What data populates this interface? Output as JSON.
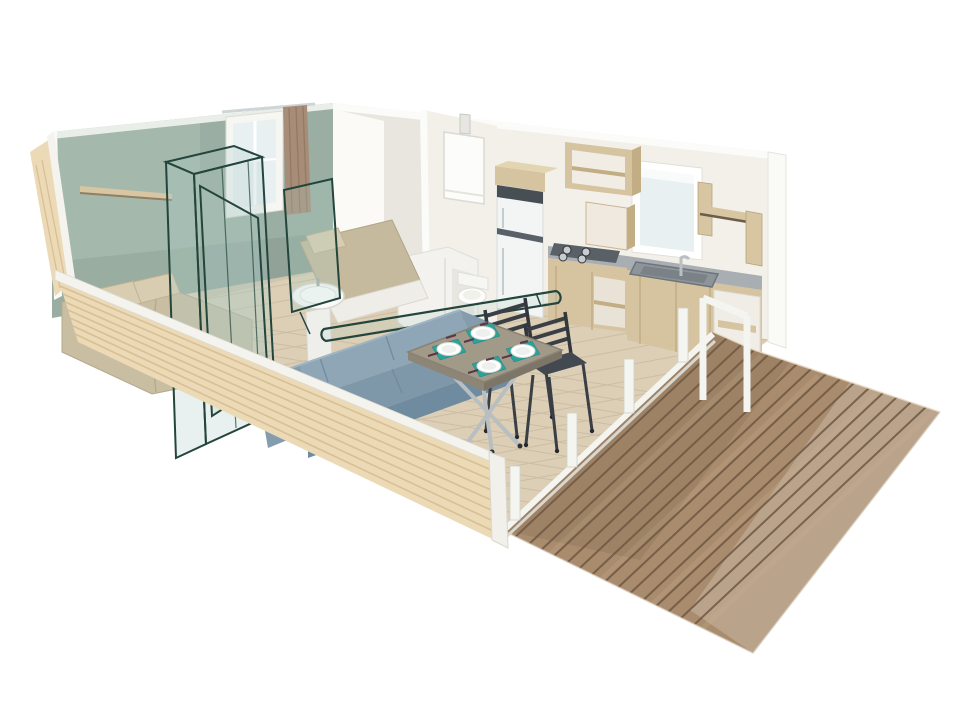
{
  "image": {
    "kind": "isometric-cutaway-render",
    "subject": "mobile-home-floorplan-3d"
  },
  "palette": {
    "background": "#ffffff",
    "wall_green": "#a4b8ac",
    "wall_green_edge": "#e9eee9",
    "wall_white_warm": "#f3f0e9",
    "wall_white_bright": "#fbfaf7",
    "wall_cut_white": "#fafaf7",
    "wood_siding": "#ecd9b6",
    "siding_stripe": "#d6bd92",
    "trim_white": "#f4f3ee",
    "floor_beige": "#dccfb6",
    "floor_line": "#b3a489",
    "deck_wood": "#a98c6e",
    "deck_gap": "#6e5741",
    "deck_light": "#c9b193",
    "railing_white": "#f4f4f0",
    "sofa_blue": "#8ea6b6",
    "sofa_blue_mid": "#7e97a9",
    "sofa_blue_dark": "#6f8ba0",
    "bed_beige": "#c9bda2",
    "pillow_beige": "#d9cdb1",
    "bed2_beige": "#c6ba9e",
    "kitchen_wood": "#d6c3a0",
    "kitchen_wood_dark": "#c3ad85",
    "counter_gray": "#a8aeb2",
    "hob_dark": "#596066",
    "basin_gray": "#8d959a",
    "appliance_white": "#f3f5f5",
    "appliance_band": "#474e54",
    "fixture_white": "#f3f2ee",
    "wireframe_teal": "#24453c",
    "wireframe_glass": "rgba(173,206,196,0.28)",
    "placemat_teal": "#2ea19b",
    "plate_white": "#ffffff",
    "cutlery_plum": "#5d3548",
    "chair_dark": "#3a3f46",
    "chair_seat": "#434950",
    "table_top": "#a29a89",
    "table_edge": "#847c6d",
    "metal_gray": "#b9bec0",
    "curtain_taupe": "#a78d77",
    "window_glass": "#e9f0f2",
    "shelf_wood": "#d8c5a2"
  },
  "scene": {
    "rooms": [
      {
        "id": "bedroom",
        "features": [
          "double-bed",
          "wall-shelf",
          "window-with-curtain",
          "wireframe-wardrobe"
        ]
      },
      {
        "id": "second-bedroom",
        "features": [
          "single-bed",
          "wireframe-rail"
        ]
      },
      {
        "id": "bathroom",
        "features": [
          "pedestal-sink",
          "shower-enclosure",
          "toilet",
          "water-heater"
        ]
      },
      {
        "id": "kitchen",
        "features": [
          "fridge",
          "overhead-open-cabinet",
          "gas-hob",
          "sink-counter",
          "wall-shelf",
          "window"
        ]
      },
      {
        "id": "living-area",
        "features": [
          "corner-sofa",
          "dining-table",
          "four-place-settings",
          "two-chairs"
        ]
      },
      {
        "id": "terrace",
        "features": [
          "wood-deck",
          "white-railing-posts",
          "door-frame"
        ]
      }
    ],
    "plates_count": 4,
    "railing_posts_count": 4
  }
}
